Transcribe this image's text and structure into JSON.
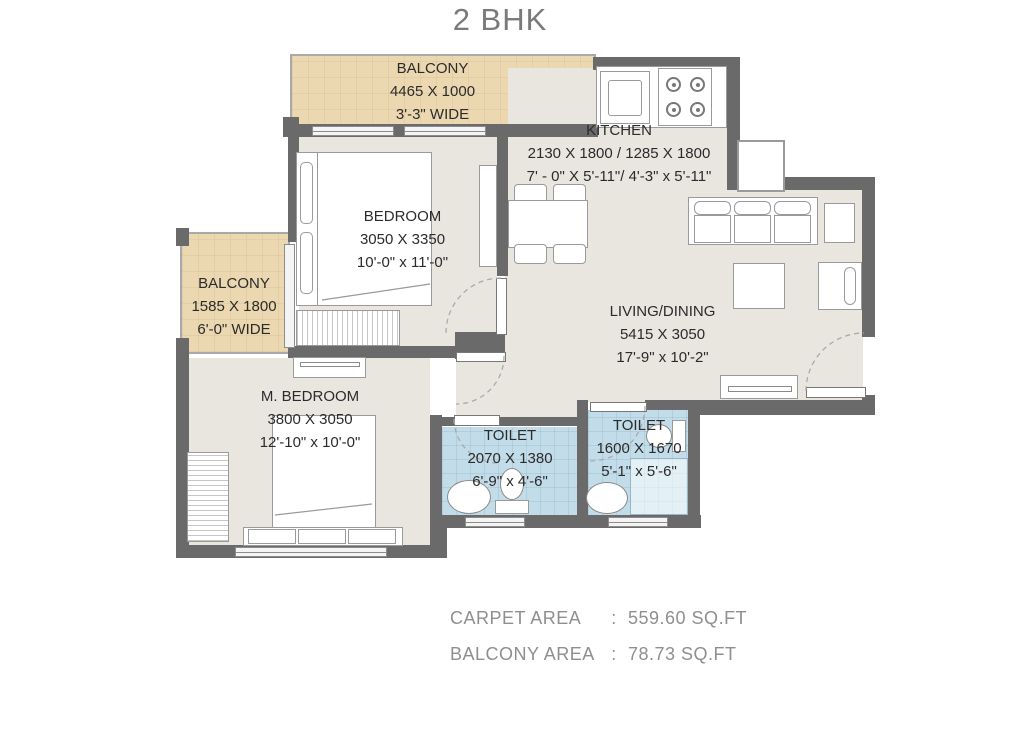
{
  "title": "2 BHK",
  "rooms": {
    "balcony_top": {
      "name": "BALCONY",
      "dim_mm": "4465 X 1000",
      "dim_ft": "3'-3\" WIDE"
    },
    "kitchen": {
      "name": "KITCHEN",
      "dim_mm": "2130 X 1800 / 1285 X 1800",
      "dim_ft": "7' - 0\" X 5'-11\"/ 4'-3\" x 5'-11\""
    },
    "bedroom": {
      "name": "BEDROOM",
      "dim_mm": "3050 X 3350",
      "dim_ft": "10'-0\" x 11'-0\""
    },
    "balcony_left": {
      "name": "BALCONY",
      "dim_mm": "1585 X 1800",
      "dim_ft": "6'-0\" WIDE"
    },
    "living_dining": {
      "name": "LIVING/DINING",
      "dim_mm": "5415 X 3050",
      "dim_ft": "17'-9\" x 10'-2\""
    },
    "master_bedroom": {
      "name": "M. BEDROOM",
      "dim_mm": "3800 X 3050",
      "dim_ft": "12'-10\" x 10'-0\""
    },
    "toilet_1": {
      "name": "TOILET",
      "dim_mm": "2070 X 1380",
      "dim_ft": "6'-9\" x 4'-6\""
    },
    "toilet_2": {
      "name": "TOILET",
      "dim_mm": "1600 X 1670",
      "dim_ft": "5'-1\" x 5'-6\""
    }
  },
  "footer": {
    "separator": ":",
    "rows": [
      {
        "label": "CARPET AREA",
        "value": "559.60 SQ.FT"
      },
      {
        "label": "BALCONY AREA",
        "value": "78.73 SQ.FT"
      }
    ]
  },
  "colors": {
    "wall": "#6a6a6a",
    "floor": "#e9e6e0",
    "balcony": "#ecd8b0",
    "toilet": "#c2dde9",
    "ink": "#2b2b2b",
    "muted": "#8f8f8f"
  }
}
